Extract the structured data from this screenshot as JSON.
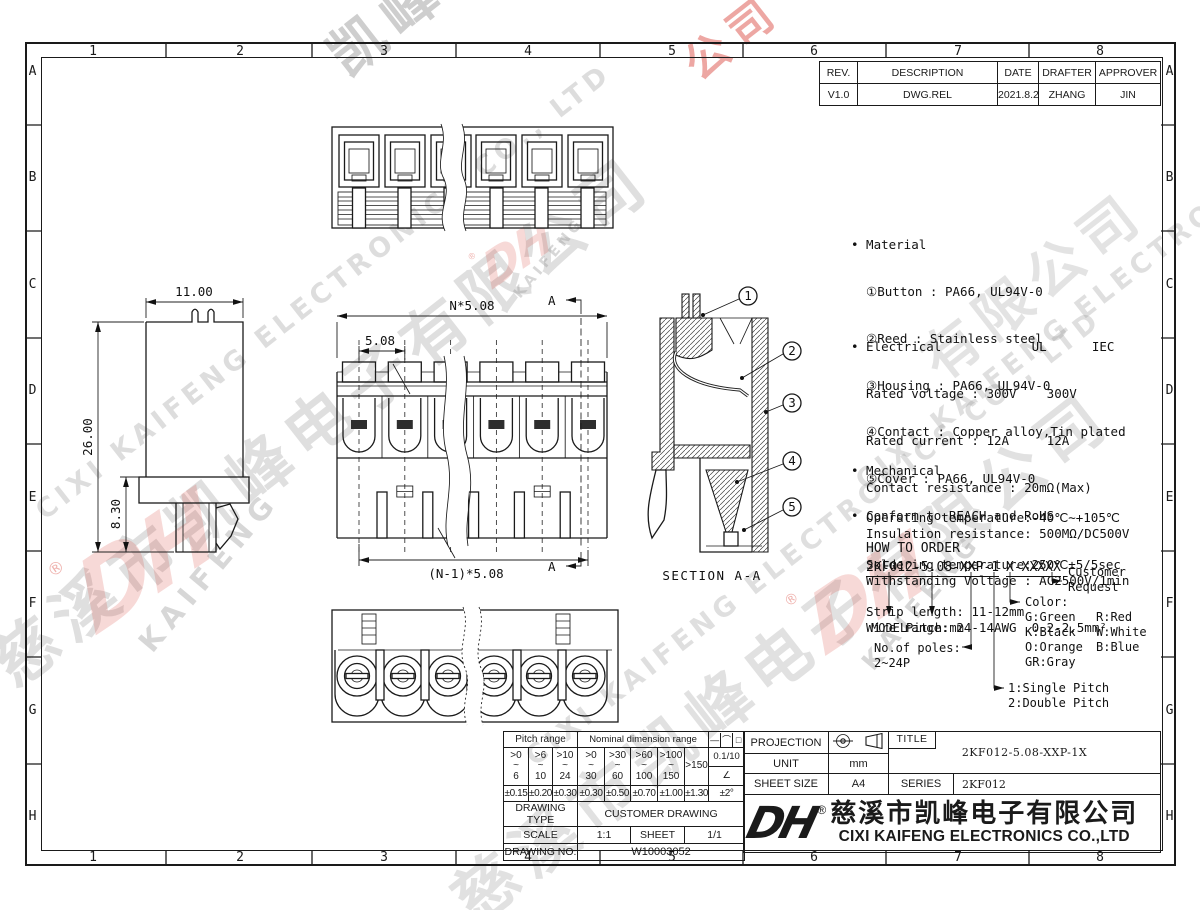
{
  "border": {
    "cols": [
      "1",
      "2",
      "3",
      "4",
      "5",
      "6",
      "7",
      "8"
    ],
    "rows": [
      "A",
      "B",
      "C",
      "D",
      "E",
      "F",
      "G",
      "H"
    ]
  },
  "revision": {
    "headers": [
      "REV.",
      "DESCRIPTION",
      "DATE",
      "DRAFTER",
      "APPROVER"
    ],
    "row": [
      "V1.0",
      "DWG.REL",
      "2021.8.25",
      "ZHANG",
      "JIN"
    ]
  },
  "notes": {
    "material": [
      "• Material",
      "  ①Button : PA66, UL94V-0",
      "  ②Reed : Stainless steel",
      "  ③Housing : PA66, UL94V-0",
      "  ④Contact : Copper alloy,Tin plated",
      "  ⑤Cover : PA66, UL94V-0"
    ],
    "electrical": [
      "• Electrical            UL      IEC",
      "  Rated voltage : 300V    300V",
      "  Rated current : 12A     12A",
      "  Contact resistance : 20mΩ(Max)",
      "  Insulation resistance: 500MΩ/DC500V",
      "  Withstanding Voltage : AC2500V/1min",
      "  Wire range: 24-14AWG  0.2-2.5mm²"
    ],
    "mechanical": [
      "• Mechanical",
      "  Operating temperature:-40℃∼+105℃",
      "  Soldering temperature:250℃±5/5sec",
      "  Strip length: 11-12mm"
    ],
    "conform": "• Conform to REACH and RoHS"
  },
  "order": {
    "title": "HOW TO ORDER",
    "code_main": "2KF012-5.08-XXP-1",
    "code_suffix": "X-XXXXX",
    "model": "MODEL",
    "pitch": "Pitch:mm",
    "poles_label": "No.of poles:",
    "poles_range": "2~24P",
    "single": "1:Single Pitch",
    "double": "2:Double Pitch",
    "color_label": "Color:",
    "colors_c1": [
      "G:Green",
      "K:Black",
      "O:Orange",
      "GR:Gray"
    ],
    "colors_c2": [
      "R:Red",
      "W:White",
      "B:Blue"
    ],
    "customer_1": "Customer",
    "customer_2": "Request"
  },
  "views": {
    "dim_width": "11.00",
    "dim_height": "26.00",
    "dim_pin": "8.30",
    "dim_pitch_total": "N*5.08",
    "dim_pitch": "5.08",
    "dim_span": "(N-1)*5.08",
    "marker": "A",
    "section_label": "SECTION A-A",
    "balloons": [
      "1",
      "2",
      "3",
      "4",
      "5"
    ]
  },
  "tol": {
    "pitch_header": "Pitch range",
    "nominal_header": "Nominal dimension range",
    "sym_line": "—",
    "sym_arc": "⌒",
    "sym_square": "□",
    "ranges": [
      ">0\n~\n6",
      ">6\n~\n10",
      ">10\n~\n24",
      ">0\n~\n30",
      ">30\n~\n60",
      ">60\n~\n100",
      ">100\n~\n150"
    ],
    "range_over": ">150",
    "flat": "0.1/10",
    "angle_sym": "∠",
    "tols": [
      "±0.15",
      "±0.20",
      "±0.30",
      "±0.30",
      "±0.50",
      "±0.70",
      "±1.00",
      "±1.30"
    ],
    "angle_tol": "±2°",
    "drawing_type_label": "DRAWING TYPE",
    "drawing_type": "CUSTOMER DRAWING",
    "scale_label": "SCALE",
    "scale": "1:1",
    "sheet_label": "SHEET",
    "sheet": "1/1",
    "drawing_no_label": "DRAWING NO.",
    "drawing_no": "W10003052"
  },
  "tb": {
    "projection_label": "PROJECTION",
    "unit_label": "UNIT",
    "unit": "mm",
    "sheet_size_label": "SHEET SIZE",
    "sheet_size": "A4",
    "title_label": "TITLE",
    "title": "2KF012-5.08-XXP-1X",
    "series_label": "SERIES",
    "series": "2KF012"
  },
  "company": {
    "logo": "DH",
    "reg": "®",
    "cn": "慈溪市凯峰电子有限公司",
    "en": "CIXI KAIFENG ELECTRONICS CO.,LTD"
  },
  "watermark": {
    "cn": "慈溪市凯峰电子有限公司",
    "cn2": "凯峰电子有限公司",
    "cn3": "有限公司",
    "en": "CIXI KAIFENG ELECTRONICS CO., LTD",
    "logo": "DH",
    "logo_sub": "KAIFENG",
    "reg": "®",
    "red_cn": "公司"
  }
}
